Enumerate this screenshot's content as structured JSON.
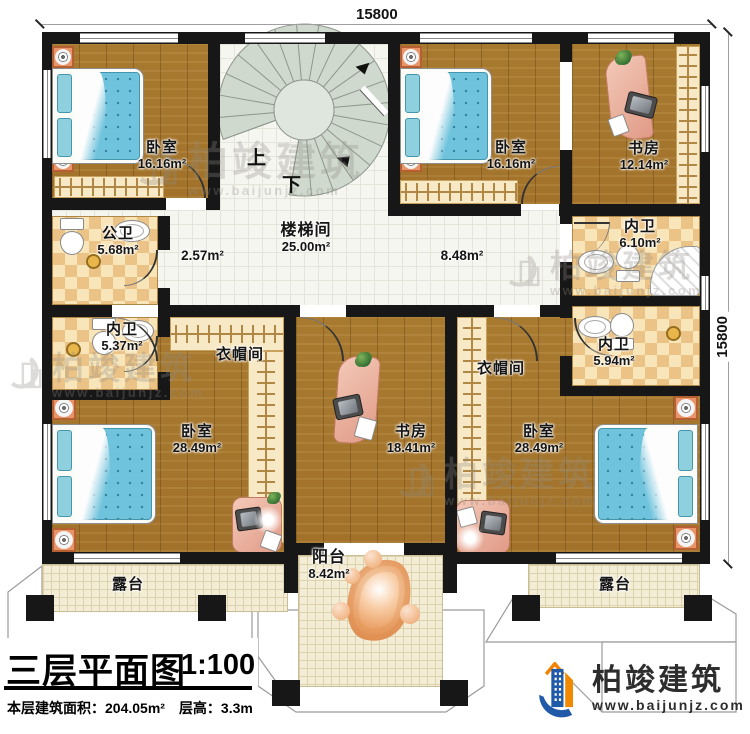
{
  "dimensions": {
    "top": "15800",
    "right": "15800"
  },
  "stairs": {
    "up": "上",
    "down": "下"
  },
  "rooms": {
    "bedroom_tl": {
      "name": "卧室",
      "area": "16.16m²"
    },
    "bedroom_tr": {
      "name": "卧室",
      "area": "16.16m²"
    },
    "study_tr": {
      "name": "书房",
      "area": "12.14m²"
    },
    "stairwell": {
      "name": "楼梯间",
      "area": "25.00m²"
    },
    "hall_left": {
      "area": "2.57m²"
    },
    "hall_right": {
      "area": "8.48m²"
    },
    "bath_public": {
      "name": "公卫",
      "area": "5.68m²"
    },
    "bath_tr": {
      "name": "内卫",
      "area": "6.10m²"
    },
    "bath_left": {
      "name": "内卫",
      "area": "5.37m²"
    },
    "bath_right": {
      "name": "内卫",
      "area": "5.94m²"
    },
    "cloak_left": {
      "name": "衣帽间"
    },
    "cloak_right": {
      "name": "衣帽间"
    },
    "bedroom_bl": {
      "name": "卧室",
      "area": "28.49m²"
    },
    "study_center": {
      "name": "书房",
      "area": "18.41m²"
    },
    "bedroom_br": {
      "name": "卧室",
      "area": "28.49m²"
    },
    "balcony": {
      "name": "阳台",
      "area": "8.42m²"
    },
    "terrace_left": {
      "name": "露台"
    },
    "terrace_right": {
      "name": "露台"
    }
  },
  "title_block": {
    "title": "三层平面图",
    "scale": "1:100",
    "area_line": "本层建筑面积：204.05m²",
    "height_line": "层高：3.3m"
  },
  "brand": {
    "name": "柏竣建筑",
    "url": "www.baijunjz.com"
  },
  "watermark": {
    "name": "柏竣建筑",
    "url": "www.baijunjz.com"
  },
  "colors": {
    "wall": "#171717",
    "wood": "#a87a30",
    "mattress": "#6fc3dc",
    "accent_orange": "#f08300",
    "accent_blue": "#1f59a8"
  }
}
